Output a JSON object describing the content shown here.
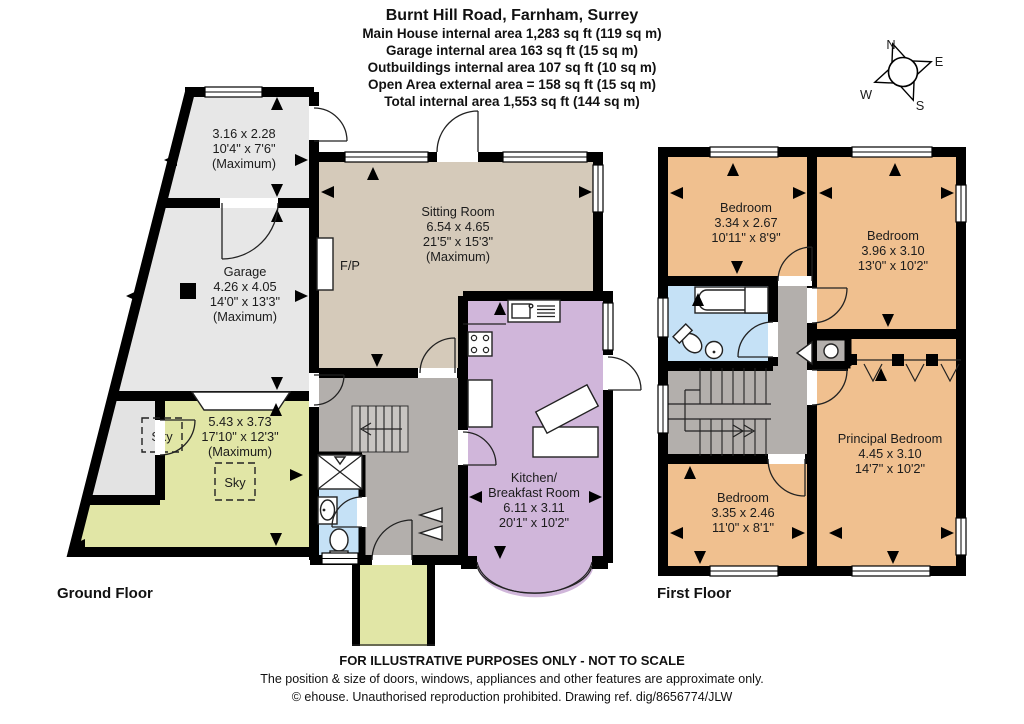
{
  "header": {
    "title": "Burnt Hill Road, Farnham, Surrey",
    "lines": [
      "Main House internal area 1,283 sq ft (119 sq m)",
      "Garage internal area 163 sq ft (15 sq m)",
      "Outbuildings internal area 107 sq ft (10 sq m)",
      "Open Area external area = 158 sq ft (15 sq m)",
      "Total internal area 1,553 sq ft (144 sq m)"
    ]
  },
  "compass": {
    "n": "N",
    "e": "E",
    "s": "S",
    "w": "W"
  },
  "ground_floor": {
    "label": "Ground Floor",
    "store": [
      "3.16 x 2.28",
      "10'4\" x 7'6\"",
      "(Maximum)"
    ],
    "garage": [
      "Garage",
      "4.26 x 4.05",
      "14'0\" x 13'3\"",
      "(Maximum)"
    ],
    "open_area": [
      "5.43 x 3.73",
      "17'10\" x 12'3\"",
      "(Maximum)"
    ],
    "sitting_room": [
      "Sitting Room",
      "6.54 x 4.65",
      "21'5\" x 15'3\"",
      "(Maximum)"
    ],
    "kitchen": [
      "Kitchen/",
      "Breakfast Room",
      "6.11 x 3.11",
      "20'1\" x 10'2\""
    ],
    "fireplace": "F/P",
    "skylight": "Sky"
  },
  "first_floor": {
    "label": "First Floor",
    "bedroom_1": [
      "Bedroom",
      "3.34 x 2.67",
      "10'11\" x 8'9\""
    ],
    "bedroom_2": [
      "Bedroom",
      "3.96 x 3.10",
      "13'0\" x 10'2\""
    ],
    "principal_bedroom": [
      "Principal Bedroom",
      "4.45 x 3.10",
      "14'7\" x 10'2\""
    ],
    "bedroom_3": [
      "Bedroom",
      "3.35 x 2.46",
      "11'0\" x 8'1\""
    ]
  },
  "footer": {
    "line1": "FOR ILLUSTRATIVE PURPOSES ONLY - NOT TO SCALE",
    "line2": "The position & size of doors, windows, appliances and other features are approximate only.",
    "line3": "© ehouse. Unauthorised reproduction prohibited. Drawing ref. dig/8656774/JLW"
  },
  "colors": {
    "bedroom": "#F0C08F",
    "kitchen": "#D0B6DA",
    "sitting": "#D5CABA",
    "outbuilding": "#E7E7E7",
    "open_area": "#E1E6A6",
    "hall": "#B3AFAC",
    "bathroom": "#C5E1F6",
    "wall": "#000000"
  }
}
